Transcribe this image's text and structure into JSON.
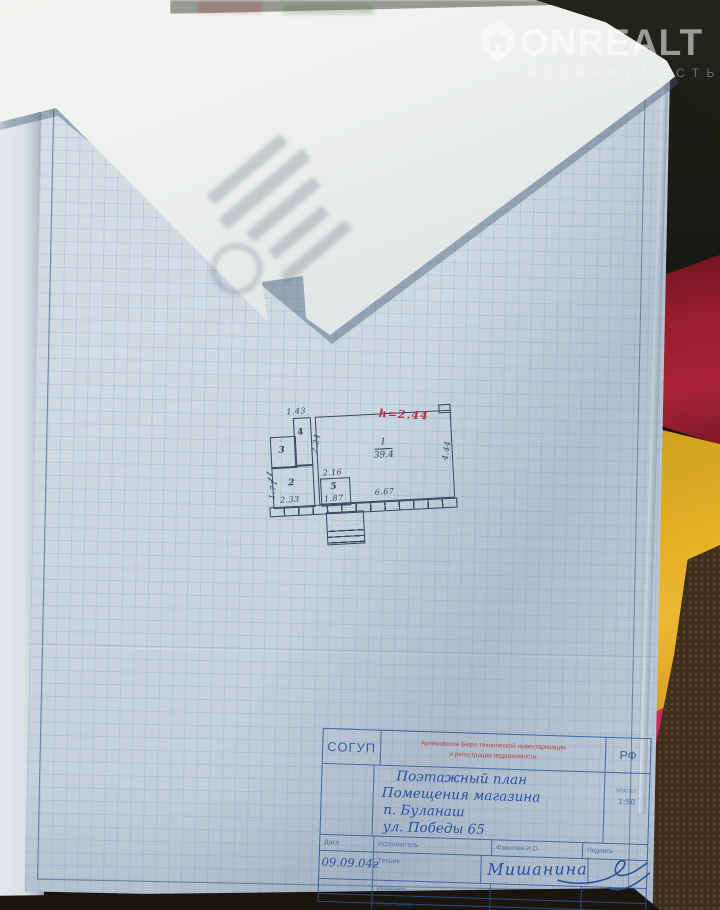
{
  "watermark": {
    "brand": "ONREALT",
    "subtitle": "НЕДВИЖИМОСТЬ"
  },
  "plan": {
    "height_note": "h=2.44",
    "room1": {
      "number": "1",
      "area": "39.4"
    },
    "room2": {
      "number": "2"
    },
    "room3": {
      "number": "3"
    },
    "room4": {
      "number": "4"
    },
    "room5": {
      "number": "5"
    },
    "dims": {
      "room4_top": "1.43",
      "room4_side": "2.24",
      "room2_side": "1.71",
      "room2_bottom": "2.33",
      "room5_top": "2.16",
      "room5_bottom": "1.87",
      "room1_bottom": "6.67",
      "room1_side": "4.44"
    }
  },
  "title_block": {
    "org_left": "СОГУП",
    "org_center": [
      "Артемовское Бюро технической инвентаризации",
      "и регистрации недвижимости"
    ],
    "org_right": "РФ",
    "title_lines": [
      "Поэтажный план",
      "Помещения магазина",
      "п. Буланаш",
      "ул. Победы 65"
    ],
    "scale_label": "Масшт.",
    "scale_value": "1:50",
    "col_headers": {
      "date": "Дата",
      "executor": "Исполнитель",
      "name": "Фамилия И.О.",
      "sign": "Подпись"
    },
    "date_value": "09.09.04г",
    "roles": [
      "Техник",
      "Инженер",
      "Начальник"
    ],
    "executor_name": "Мишанина"
  }
}
